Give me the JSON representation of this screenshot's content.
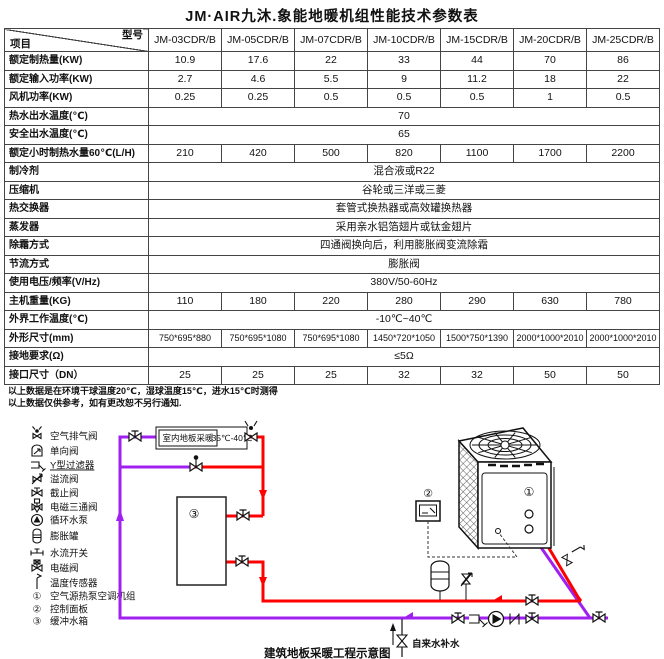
{
  "title": "JM·AIR九沐.象能地暖机组性能技术参数表",
  "table": {
    "corner": {
      "top_right": "型号",
      "bottom_left": "项目"
    },
    "columns": [
      "JM-03CDR/B",
      "JM-05CDR/B",
      "JM-07CDR/B",
      "JM-10CDR/B",
      "JM-15CDR/B",
      "JM-20CDR/B",
      "JM-25CDR/B"
    ],
    "rows": [
      {
        "label": "额定制热量(KW)",
        "values": [
          "10.9",
          "17.6",
          "22",
          "33",
          "44",
          "70",
          "86"
        ]
      },
      {
        "label": "额定输入功率(KW)",
        "values": [
          "2.7",
          "4.6",
          "5.5",
          "9",
          "11.2",
          "18",
          "22"
        ]
      },
      {
        "label": "风机功率(KW)",
        "values": [
          "0.25",
          "0.25",
          "0.5",
          "0.5",
          "0.5",
          "1",
          "0.5"
        ]
      },
      {
        "label": "热水出水温度(℃)",
        "span": "70"
      },
      {
        "label": "安全出水温度(℃)",
        "span": "65"
      },
      {
        "label": "额定小时制热水量60℃(L/H)",
        "values": [
          "210",
          "420",
          "500",
          "820",
          "1100",
          "1700",
          "2200"
        ]
      },
      {
        "label": "制冷剂",
        "span": "混合液或R22"
      },
      {
        "label": "压缩机",
        "span": "谷轮或三洋或三菱"
      },
      {
        "label": "热交换器",
        "span": "套管式换热器或高效罐换热器"
      },
      {
        "label": "蒸发器",
        "span": "采用亲水铝箔翅片或钛金翅片"
      },
      {
        "label": "除霜方式",
        "span": "四通阀换向后，利用膨胀阀变流除霜"
      },
      {
        "label": "节流方式",
        "span": "膨胀阀"
      },
      {
        "label": "使用电压/频率(V/Hz)",
        "span": "380V/50-60Hz"
      },
      {
        "label": "主机重量(KG)",
        "values": [
          "110",
          "180",
          "220",
          "280",
          "290",
          "630",
          "780"
        ]
      },
      {
        "label": "外界工作温度(℃)",
        "span": "-10℃~40℃"
      },
      {
        "label": "外形尺寸(mm)",
        "values": [
          "750*695*880",
          "750*695*1080",
          "750*695*1080",
          "1450*720*1050",
          "1500*750*1390",
          "2000*1000*2010",
          "2000*1000*2010"
        ]
      },
      {
        "label": "接地要求(Ω)",
        "span": "≤5Ω"
      },
      {
        "label": "接口尺寸（DN）",
        "values": [
          "25",
          "25",
          "25",
          "32",
          "32",
          "50",
          "50"
        ]
      }
    ]
  },
  "notes": [
    "以上数据是在环境干球温度20℃，湿球温度15℃，进水15℃时测得",
    "以上数据仅供参考，如有更改恕不另行通知."
  ],
  "legend": {
    "items": [
      {
        "icon": "air-vent-valve-icon",
        "label": "空气排气阀"
      },
      {
        "icon": "check-valve-icon",
        "label": "单向阀"
      },
      {
        "icon": "y-filter-icon",
        "label": "Y型过滤器",
        "underline": true
      },
      {
        "icon": "overflow-valve-icon",
        "label": "溢流阀"
      },
      {
        "icon": "stop-valve-icon",
        "label": "截止阀"
      },
      {
        "icon": "solenoid-three-way-valve-icon",
        "label": "电磁三通阀"
      },
      {
        "icon": "circulating-pump-icon",
        "label": "循环水泵"
      },
      {
        "icon": "expansion-tank-icon",
        "label": "膨胀罐"
      },
      {
        "icon": "water-flow-switch-icon",
        "label": "水流开关"
      },
      {
        "icon": "solenoid-valve-icon",
        "label": "电磁阀"
      },
      {
        "icon": "temperature-sensor-icon",
        "label": "温度传感器"
      },
      {
        "marker": "①",
        "label": "空气源热泵空调机组"
      },
      {
        "marker": "②",
        "label": "控制面板"
      },
      {
        "marker": "③",
        "label": "缓冲水箱"
      }
    ]
  },
  "diagram": {
    "floor_heating_label": "室内地板采暖",
    "temp_range": "35℃-40℃",
    "unit_marker": "①",
    "panel_marker": "②",
    "tank_marker": "③",
    "makeup_water_label": "自来水补水",
    "caption": "建筑地板采暖工程示意图",
    "colors": {
      "supply_pipe": "#FF0000",
      "return_pipe": "#A020F0"
    }
  }
}
